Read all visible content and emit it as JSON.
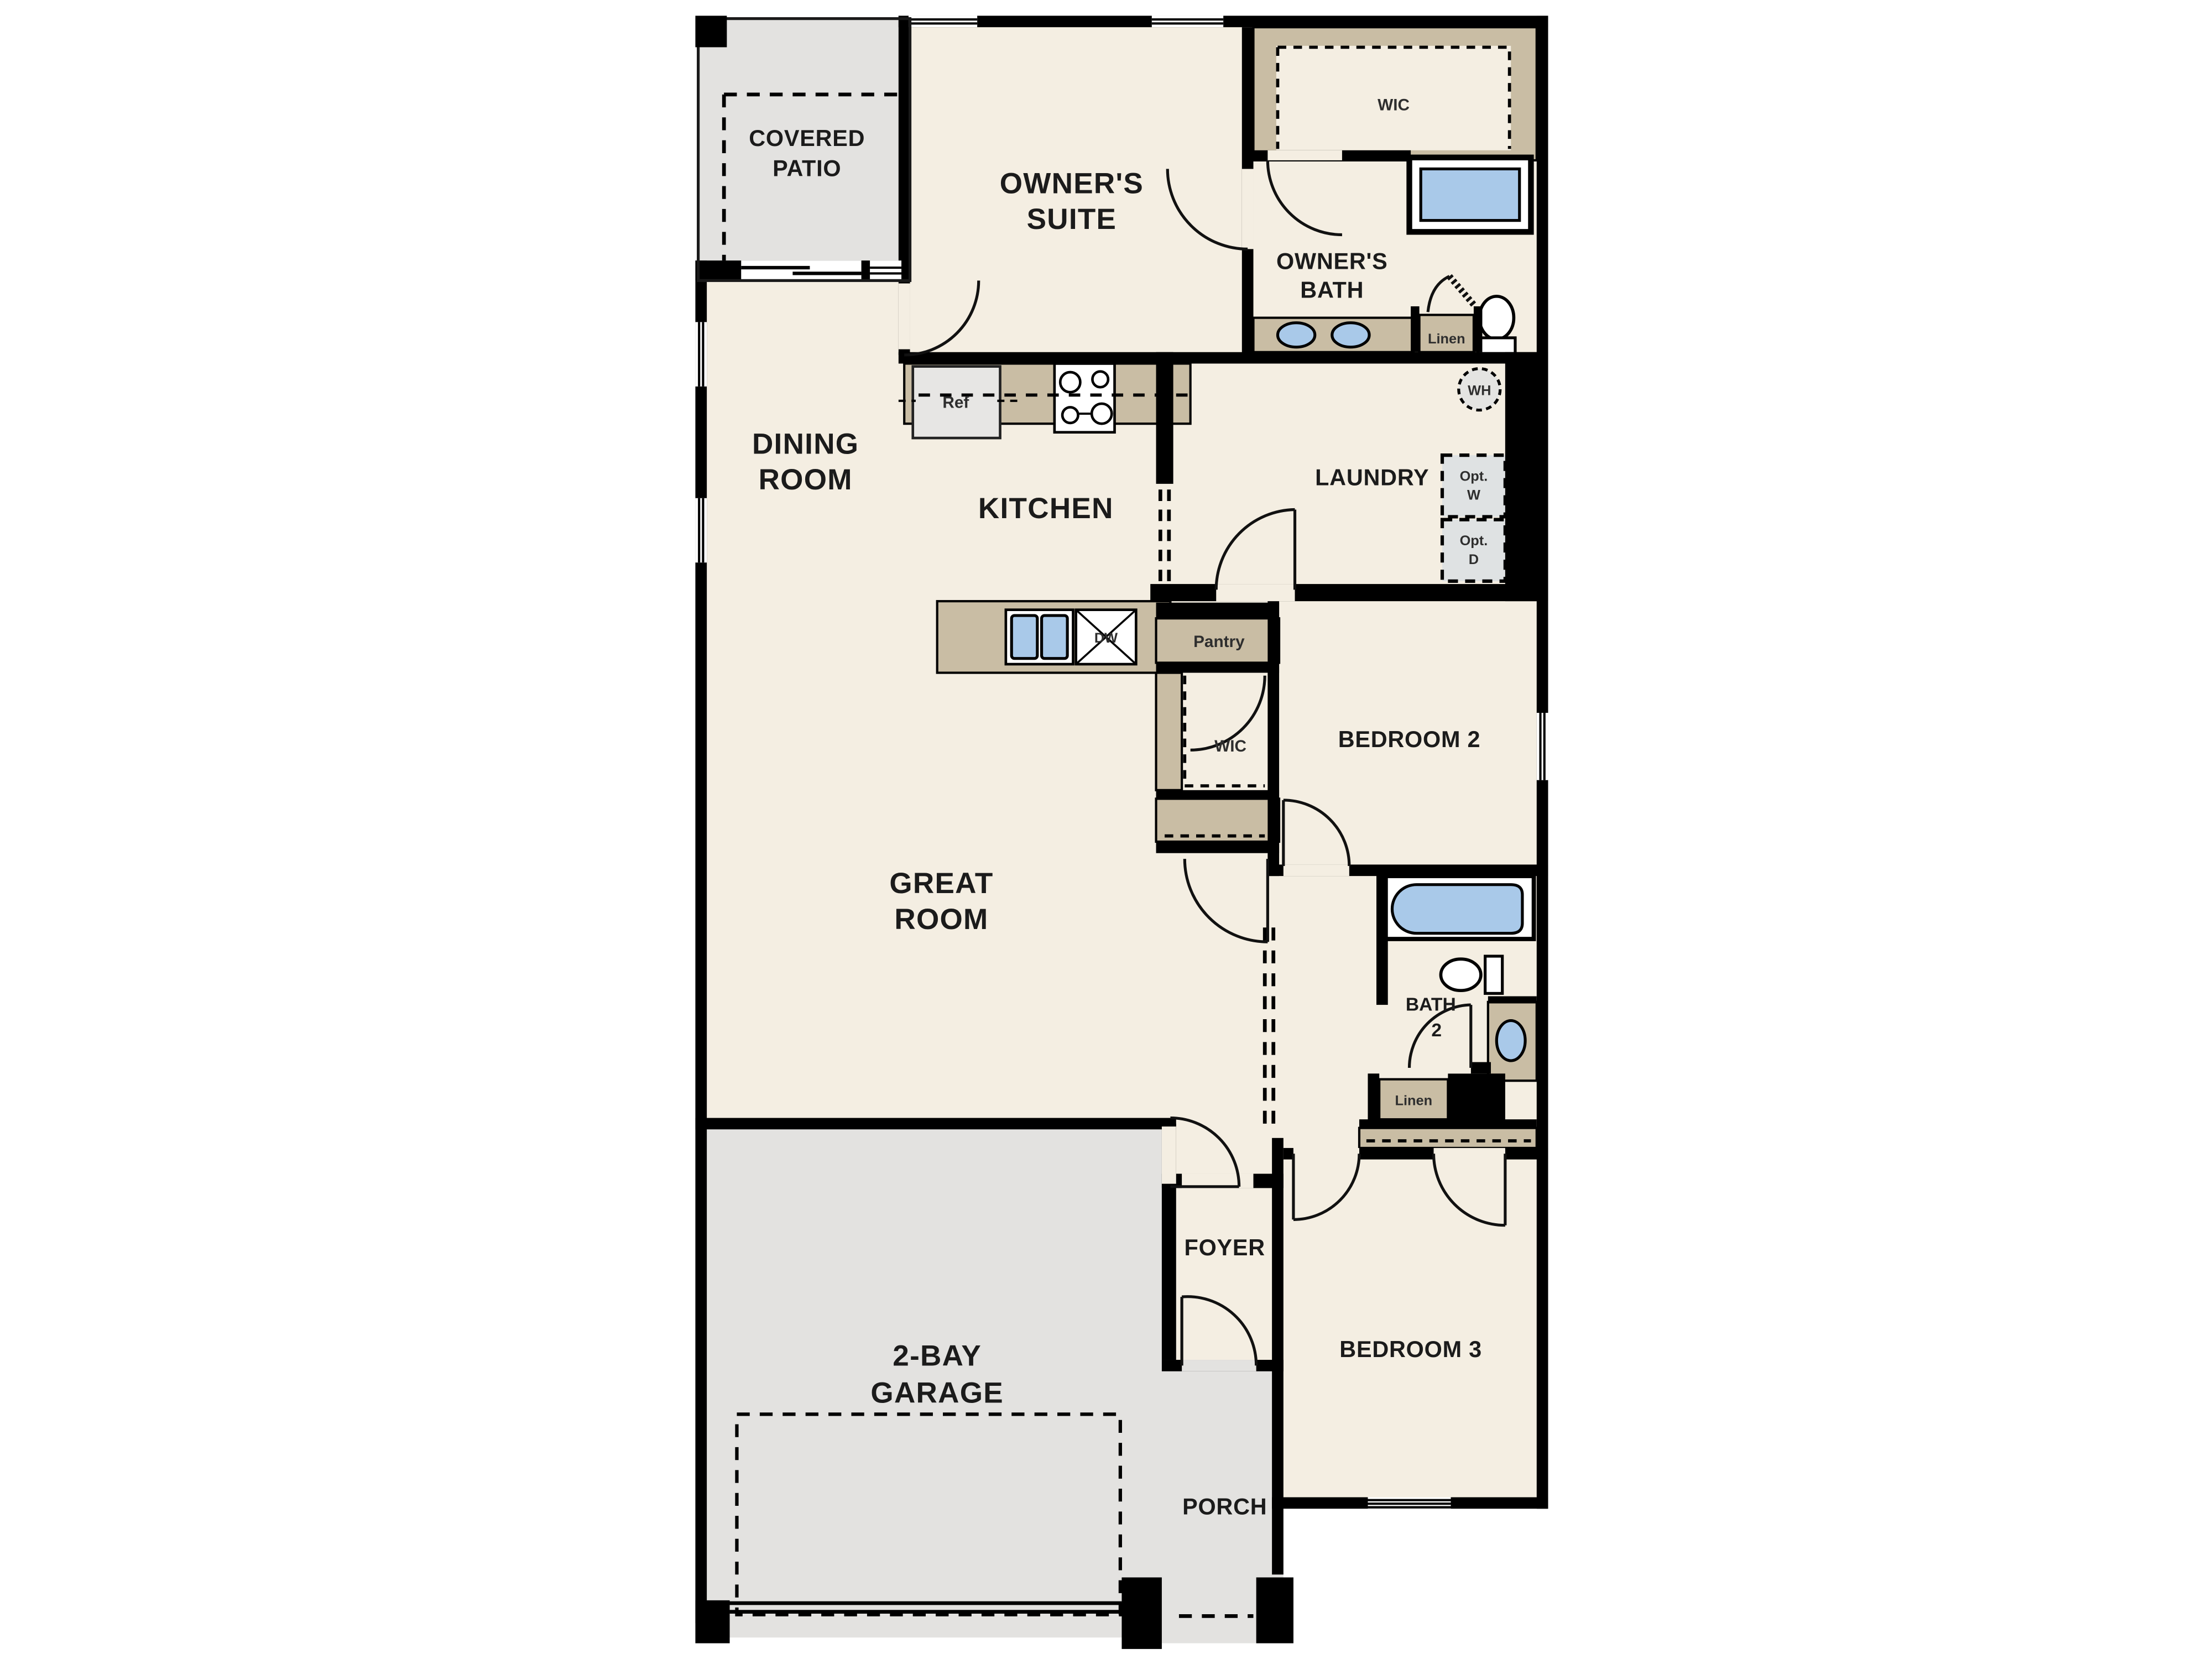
{
  "plan_title": "Single-story 3-bedroom floor plan",
  "rooms": {
    "covered_patio": [
      "COVERED",
      "PATIO"
    ],
    "owners_suite": [
      "OWNER'S",
      "SUITE"
    ],
    "owners_bath": [
      "OWNER'S",
      "BATH"
    ],
    "wic_owner": "WIC",
    "dining_room": [
      "DINING",
      "ROOM"
    ],
    "kitchen": "KITCHEN",
    "laundry": "LAUNDRY",
    "wic_hall": "WIC",
    "bedroom2": "BEDROOM 2",
    "great_room": [
      "GREAT",
      "ROOM"
    ],
    "bath2": [
      "BATH",
      "2"
    ],
    "foyer": "FOYER",
    "bedroom3": "BEDROOM 3",
    "garage": [
      "2-BAY",
      "GARAGE"
    ],
    "porch": "PORCH"
  },
  "fixtures": {
    "refrigerator": "Ref",
    "dishwasher": "DW",
    "pantry": "Pantry",
    "water_heater": "WH",
    "optional_washer": [
      "Opt.",
      "W"
    ],
    "optional_dryer": [
      "Opt.",
      "D"
    ],
    "linen_owner": "Linen",
    "linen_bath2": "Linen"
  },
  "colors": {
    "wall": "#000000",
    "floor_cream": "#f4eee2",
    "concrete_gray": "#e3e2e0",
    "casework_tan": "#c9bda4",
    "fixture_blue": "#a9c9e9",
    "appliance_gray": "#e7e6e4",
    "label_text": "#1b1b1b",
    "background": "#ffffff"
  }
}
